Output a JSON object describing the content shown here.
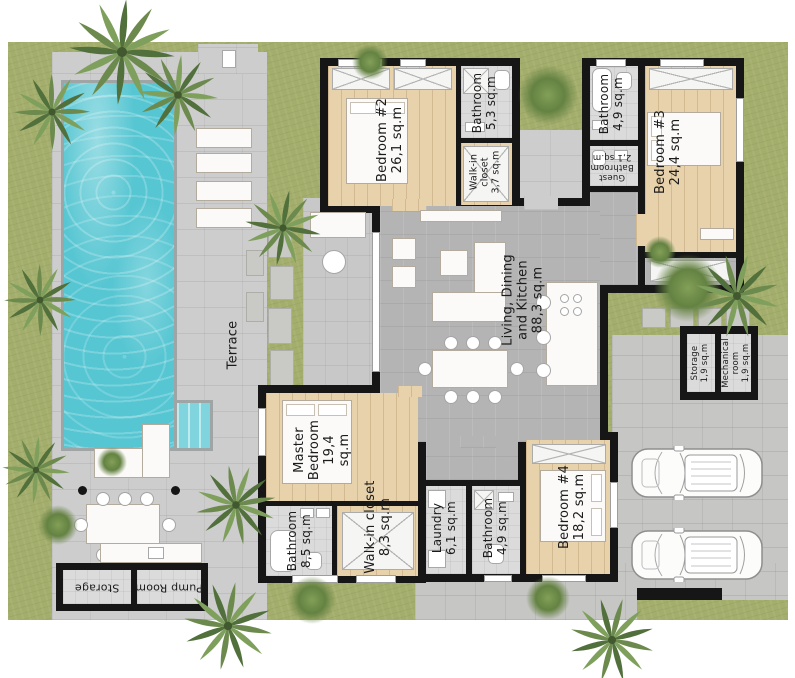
{
  "plan_title": "Villa floor plan with pool and 2-car parking",
  "rooms": {
    "bedroom2": {
      "name": "Bedroom #2",
      "area": "26,1 sq.m"
    },
    "bathroom2": {
      "name": "Bathroom",
      "area": "5,3 sq.m"
    },
    "closet2": {
      "name": "Walk-in closet",
      "area": "3,7 sq.m"
    },
    "bathroom3": {
      "name": "Bathroom",
      "area": "4,9 sq.m"
    },
    "guest_bathroom": {
      "name": "Guest Bathroom",
      "area": "2,1 sq.m"
    },
    "bedroom3": {
      "name": "Bedroom #3",
      "area": "24,4 sq.m"
    },
    "living": {
      "name": "Living, Dining and Kitchen",
      "area": "88,3 sq.m"
    },
    "terrace": {
      "name": "Terrace"
    },
    "storage_right": {
      "name": "Storage",
      "area": "1,9 sq.m"
    },
    "mechanical": {
      "name": "Mechanical room",
      "area": "1,9 sq.m"
    },
    "master": {
      "name": "Master Bedroom",
      "area": "19,4 sq.m"
    },
    "master_bath": {
      "name": "Bathroom",
      "area": "8,5 sq.m"
    },
    "master_closet": {
      "name": "Walk-in closet",
      "area": "8,3 sq.m"
    },
    "laundry": {
      "name": "Laundry",
      "area": "6,1 sq.m"
    },
    "bathroom4": {
      "name": "Bathroom",
      "area": "4,9 sq.m"
    },
    "bedroom4": {
      "name": "Bedroom #4",
      "area": "18,2 sq.m"
    },
    "storage_left": {
      "name": "Storage"
    },
    "pump_room": {
      "name": "Pump Room"
    }
  },
  "colors": {
    "grass": "#a4ae6c",
    "pool_water": "#56c6d2",
    "deck": "#cdcdcd",
    "driveway": "#c6c6c4",
    "wood_floor": "#e8d2ac",
    "tile_floor": "#b4b4b4",
    "bath_floor": "#dbdbdb",
    "walls": "#161616",
    "palm_green": "#6c8a4d"
  }
}
